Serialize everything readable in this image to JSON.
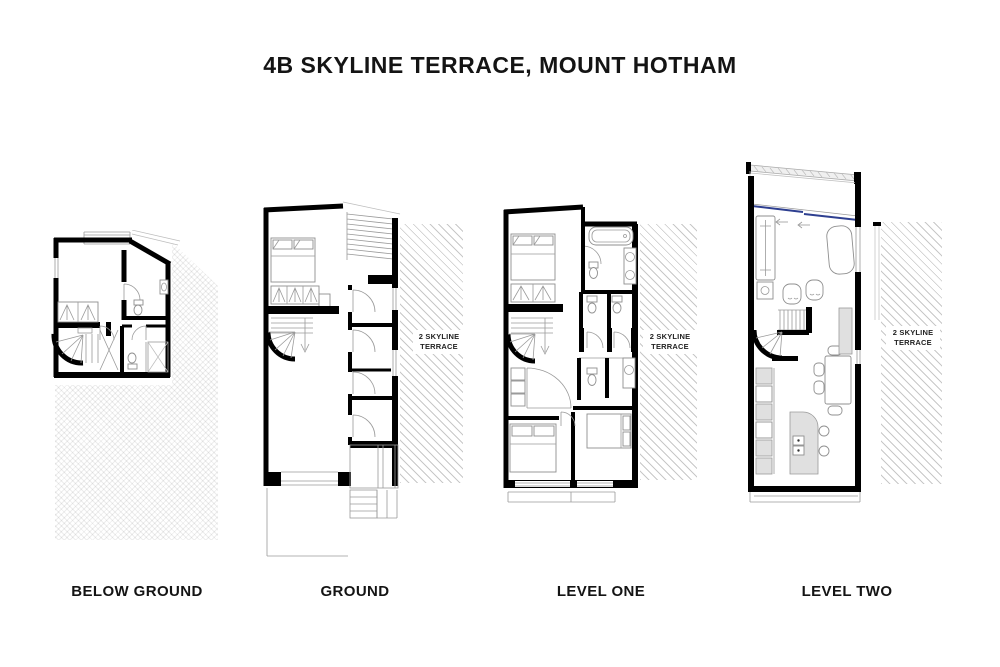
{
  "title": "4B SKYLINE TERRACE, MOUNT HOTHAM",
  "colors": {
    "background": "#ffffff",
    "walls": "#000000",
    "hatch_line": "#c8c8c8",
    "line_gray": "#9a9a9a",
    "furniture_line": "#8f8f8f",
    "fill_light": "#e0e0e0",
    "sliding_door_blue": "#2e3f90",
    "label_text": "#141414"
  },
  "floors": [
    {
      "id": "below-ground",
      "label": "BELOW GROUND"
    },
    {
      "id": "ground",
      "label": "GROUND",
      "adjacent_label": "2 SKYLINE TERRACE"
    },
    {
      "id": "level-one",
      "label": "LEVEL ONE",
      "adjacent_label": "2 SKYLINE TERRACE"
    },
    {
      "id": "level-two",
      "label": "LEVEL TWO",
      "adjacent_label": "2 SKYLINE TERRACE"
    }
  ]
}
